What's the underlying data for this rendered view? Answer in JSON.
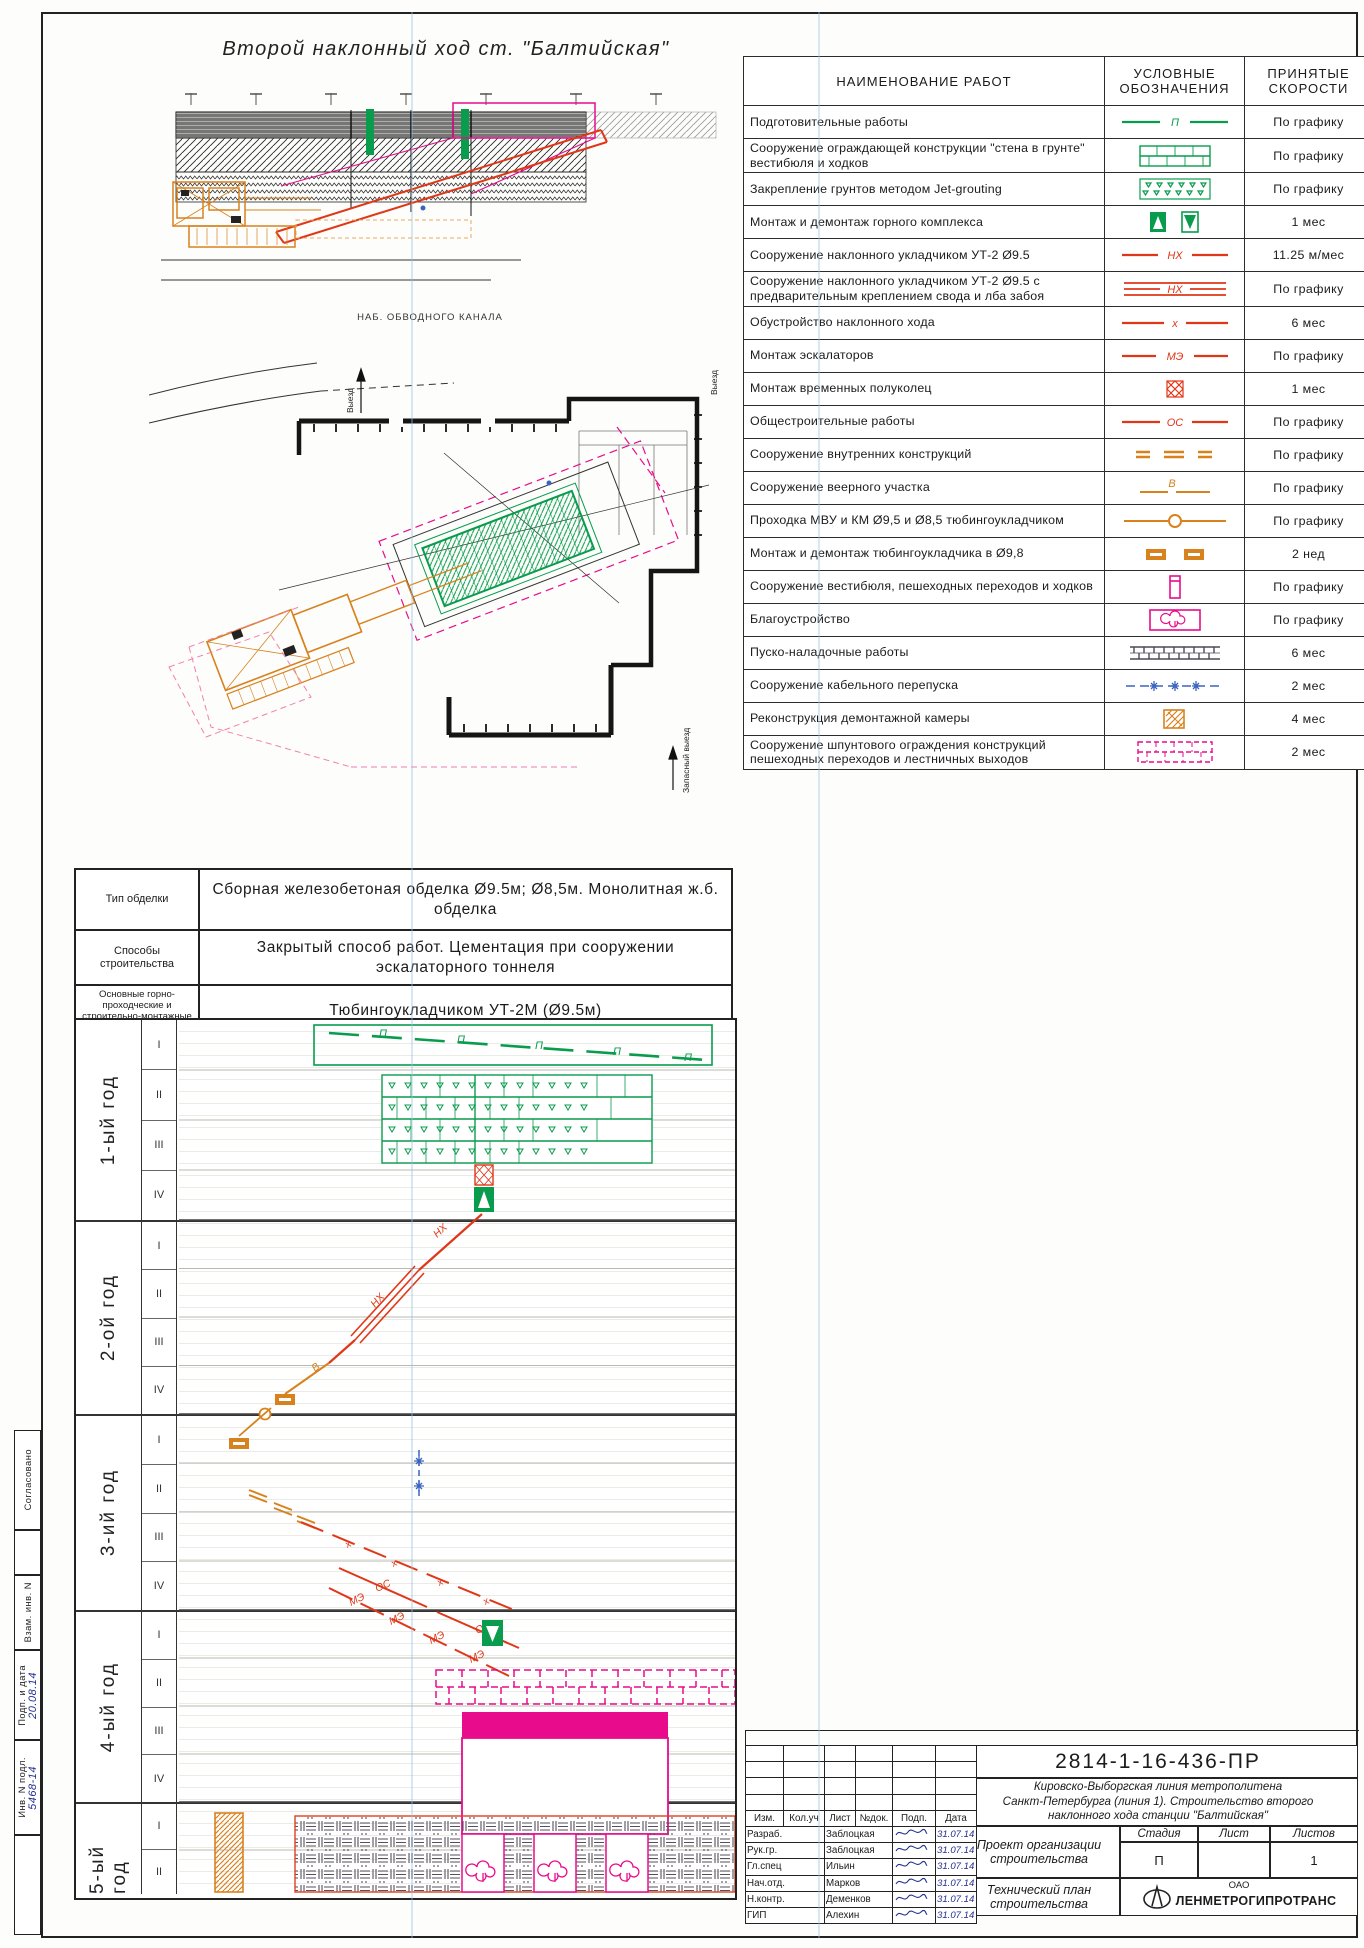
{
  "sheet": {
    "drawing_title": "Второй наклонный ход ст. \"Балтийская\"",
    "section_label": "НАБ. ОБВОДНОГО КАНАЛА",
    "plan_labels": {
      "exit": "Выезд",
      "exit2": "Выезд",
      "emergency_exit": "Запасный выезд"
    }
  },
  "legend": {
    "col_headers": [
      "НАИМЕНОВАНИЕ   РАБОТ",
      "УСЛОВНЫЕ ОБОЗНАЧЕНИЯ",
      "ПРИНЯТЫЕ СКОРОСТИ"
    ],
    "rows": [
      {
        "name": "Подготовительные работы",
        "symbol": "green-dash-p",
        "speed": "По графику"
      },
      {
        "name": "Сооружение ограждающей конструкции \"стена в грунте\" вестибюля и ходков",
        "symbol": "green-brick",
        "speed": "По графику"
      },
      {
        "name": "Закрепление грунтов методом Jet-grouting",
        "symbol": "green-jet",
        "speed": "По графику"
      },
      {
        "name": "Монтаж и демонтаж горного комплекса",
        "symbol": "green-updown",
        "speed": "1 мес"
      },
      {
        "name": "Сооружение наклонного укладчиком УТ-2 Ø9.5",
        "symbol": "red-nh",
        "speed": "11.25 м/мес"
      },
      {
        "name": "Сооружение наклонного укладчиком УТ-2 Ø9.5 с предварительным креплением свода и лба забоя",
        "symbol": "red-nh-triple",
        "speed": "По графику"
      },
      {
        "name": "Обустройство наклонного хода",
        "symbol": "red-x",
        "speed": "6 мес"
      },
      {
        "name": "Монтаж эскалаторов",
        "symbol": "red-me",
        "speed": "По графику"
      },
      {
        "name": "Монтаж временных полуколец",
        "symbol": "red-crosshatch",
        "speed": "1 мес"
      },
      {
        "name": "Общестроительные работы",
        "symbol": "red-os",
        "speed": "По графику"
      },
      {
        "name": "Сооружение внутренних конструкций",
        "symbol": "orange-dashes",
        "speed": "По графику"
      },
      {
        "name": "Сооружение веерного участка",
        "symbol": "orange-b",
        "speed": "По графику"
      },
      {
        "name": "Проходка МВУ и КМ Ø9,5 и Ø8,5 тюбингоукладчиком",
        "symbol": "orange-circle",
        "speed": "По графику"
      },
      {
        "name": "Монтаж и демонтаж тюбингоукладчика в Ø9,8",
        "symbol": "orange-boxes",
        "speed": "2 нед"
      },
      {
        "name": "Сооружение вестибюля, пешеходных переходов и ходков",
        "symbol": "magenta-vrect",
        "speed": "По графику"
      },
      {
        "name": "Благоустройство",
        "symbol": "magenta-tree",
        "speed": "По графику"
      },
      {
        "name": "Пуско-наладочные работы",
        "symbol": "dark-hatch-bar",
        "speed": "6 мес"
      },
      {
        "name": "Сооружение кабельного перепуска",
        "symbol": "blue-stars",
        "speed": "2 мес"
      },
      {
        "name": "Реконструкция демонтажной камеры",
        "symbol": "orange-weave",
        "speed": "4 мес"
      },
      {
        "name": "Сооружение шпунтового ограждения конструкций пешеходных переходов и лестничных выходов",
        "symbol": "magenta-brick-dashed",
        "speed": "2 мес"
      }
    ]
  },
  "spec": {
    "rows": [
      {
        "label": "Тип обделки",
        "value": "Сборная железобетоная обделка Ø9.5м;  Ø8,5м.  Монолитная ж.б. обделка"
      },
      {
        "label": "Способы строительства",
        "value": "Закрытый способ работ. Цементация при сооружении эскалаторного тоннеля"
      },
      {
        "label": "Основные горно-проходческие и строительно-монтажные механизмы",
        "value": "Тюбингоукладчиком УТ-2М (Ø9.5м)"
      }
    ]
  },
  "schedule": {
    "years": [
      "1-ый год",
      "2-ой год",
      "3-ий год",
      "4-ый год",
      "5-ый год"
    ],
    "quarters": [
      "I",
      "II",
      "III",
      "IV"
    ],
    "gantt_labels": {
      "p": "П",
      "nh": "НХ",
      "v": "В",
      "os": "ОС",
      "me": "МЭ",
      "x": "x"
    }
  },
  "titleblock": {
    "doc_number": "2814-1-16-436-ПР",
    "project": "Кировско-Выборгская линия метрополитена\nСанкт-Петербурга (линия 1). Строительство второго\nнаклонного хода станции \"Балтийская\"",
    "columns": [
      "Изм.",
      "Кол.уч",
      "Лист",
      "№док.",
      "Подп.",
      "Дата"
    ],
    "staff": [
      {
        "role": "Разраб.",
        "name": "Заблоцкая",
        "date": "31.07.14"
      },
      {
        "role": "Рук.гр.",
        "name": "Заблоцкая",
        "date": "31.07.14"
      },
      {
        "role": "Гл.спец",
        "name": "Ильин",
        "date": "31.07.14"
      },
      {
        "role": "Нач.отд.",
        "name": "Марков",
        "date": "31.07.14"
      },
      {
        "role": "Н.контр.",
        "name": "Деменков",
        "date": "31.07.14"
      },
      {
        "role": "ГИП",
        "name": "Алехин",
        "date": "31.07.14"
      }
    ],
    "doc_type": "Проект организации строительства",
    "stage_label": "Стадия",
    "stage": "П",
    "sheet_label": "Лист",
    "sheet": "",
    "sheets_label": "Листов",
    "sheets": "1",
    "subtitle": "Технический план строительства",
    "company_prefix": "ОАО",
    "company": "ЛЕНМЕТРОГИПРОТРАНС"
  },
  "margin": {
    "agreed": "Согласовано",
    "inv_label": "Инв. N подл.",
    "inv_value": "5468-14",
    "sign_label": "Подп. и дата",
    "sign_value": "20.08.14",
    "repl_label": "Взам. инв. N"
  },
  "colors": {
    "green": "#089c4c",
    "red": "#e03718",
    "orange": "#d8821e",
    "magenta": "#e80c8c",
    "blue": "#3b64c0",
    "dark": "#4a4a55"
  }
}
